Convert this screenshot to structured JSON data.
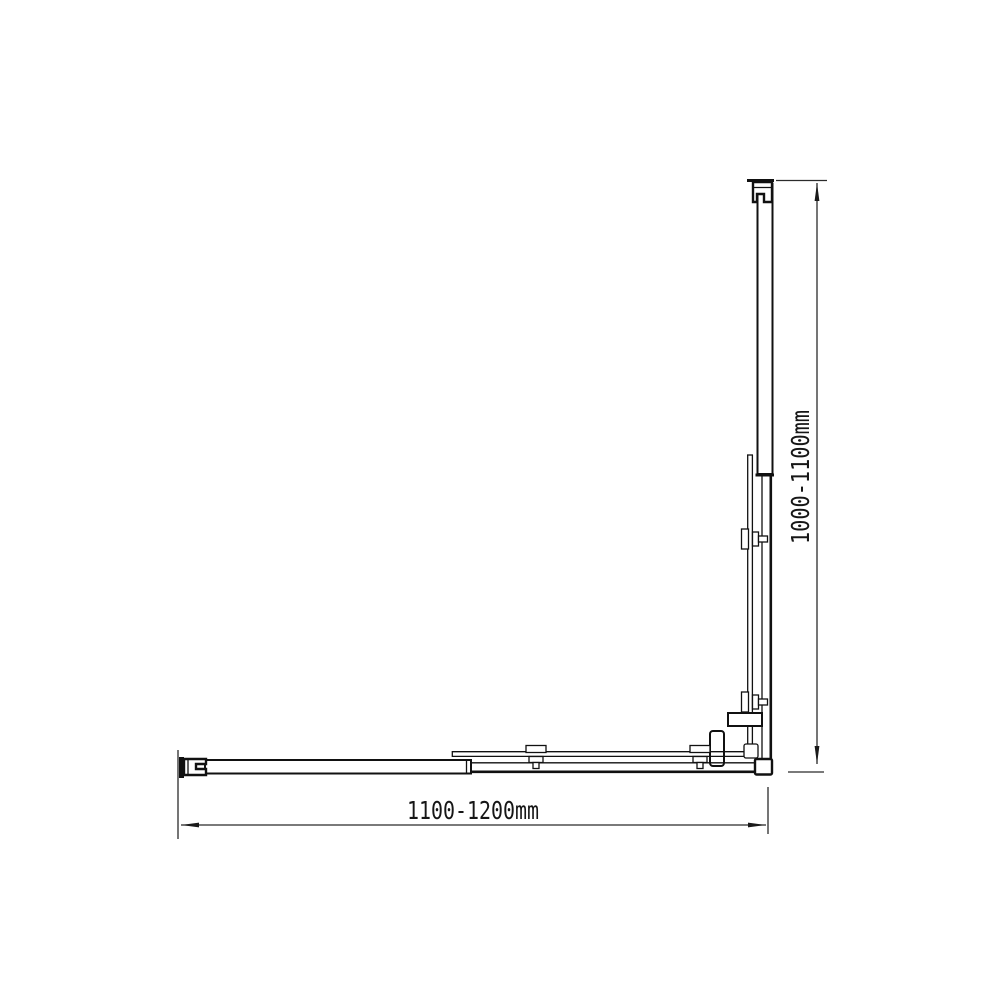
{
  "labels": {
    "width_range": "1100-1200mm",
    "height_range": "1000-1100mm"
  },
  "colors": {
    "background": "#ffffff",
    "line": "#111111",
    "dimension_line": "#2b2b2b",
    "text": "#161616",
    "clamp_fill": "#9a9a9a"
  },
  "drawing": {
    "kind": "technical-dimension-diagram"
  }
}
